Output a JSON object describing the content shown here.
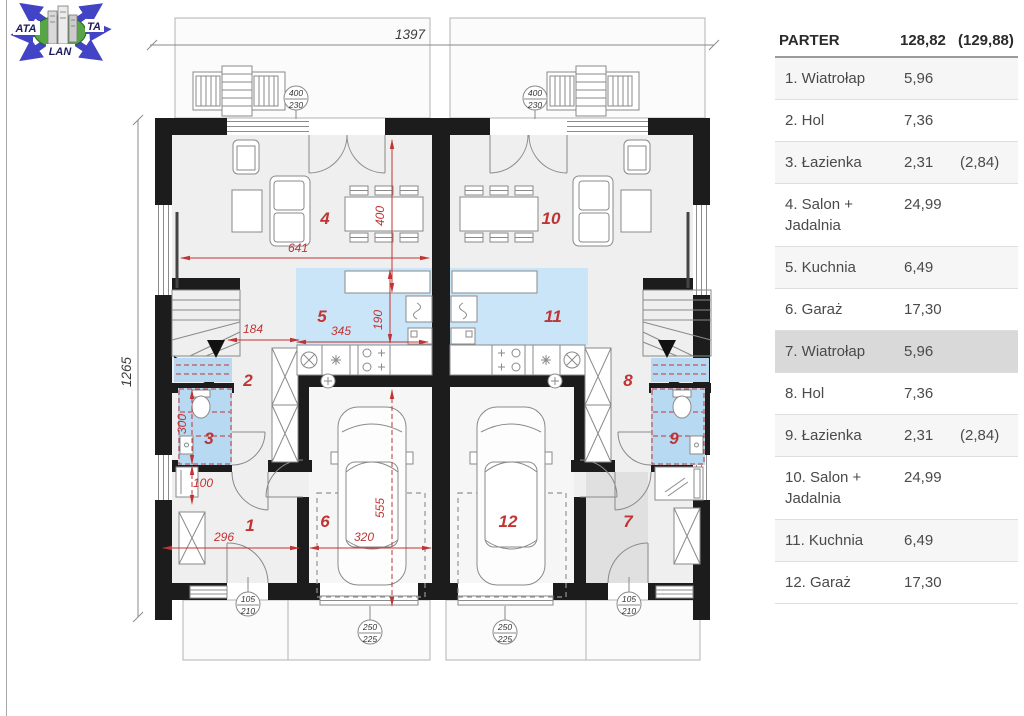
{
  "logo": {
    "left": "ATA",
    "right": "TA",
    "bottom": "LAN"
  },
  "legend": {
    "title": "PARTER",
    "total": "128,82",
    "total_alt": "(129,88)",
    "rows": [
      {
        "label": "1. Wiatrołap",
        "area": "5,96",
        "area_alt": ""
      },
      {
        "label": "2. Hol",
        "area": "7,36",
        "area_alt": ""
      },
      {
        "label": "3. Łazienka",
        "area": "2,31",
        "area_alt": "(2,84)"
      },
      {
        "label": "4. Salon + Jadalnia",
        "area": "24,99",
        "area_alt": ""
      },
      {
        "label": "5. Kuchnia",
        "area": "6,49",
        "area_alt": ""
      },
      {
        "label": "6. Garaż",
        "area": "17,30",
        "area_alt": ""
      },
      {
        "label": "7. Wiatrołap",
        "area": "5,96",
        "area_alt": ""
      },
      {
        "label": "8. Hol",
        "area": "7,36",
        "area_alt": ""
      },
      {
        "label": "9. Łazienka",
        "area": "2,31",
        "area_alt": "(2,84)"
      },
      {
        "label": "10. Salon + Jadalnia",
        "area": "24,99",
        "area_alt": ""
      },
      {
        "label": "11. Kuchnia",
        "area": "6,49",
        "area_alt": ""
      },
      {
        "label": "12. Garaż",
        "area": "17,30",
        "area_alt": ""
      }
    ]
  },
  "plan": {
    "overall_width": "1397",
    "overall_height": "1265",
    "rooms": {
      "n1": "1",
      "n2": "2",
      "n3": "3",
      "n4": "4",
      "n5": "5",
      "n6": "6",
      "n7": "7",
      "n8": "8",
      "n9": "9",
      "n10": "10",
      "n11": "11",
      "n12": "12"
    },
    "dims": {
      "d641": "641",
      "d400": "400",
      "d345": "345",
      "d190": "190",
      "d184": "184",
      "d300": "300",
      "d100": "100",
      "d296": "296",
      "d320": "320",
      "d555": "555"
    },
    "markers": {
      "win_top": "400",
      "win_bot": "230",
      "entry_top": "105",
      "entry_bot": "210",
      "gar_top": "250",
      "gar_bot": "225"
    }
  }
}
